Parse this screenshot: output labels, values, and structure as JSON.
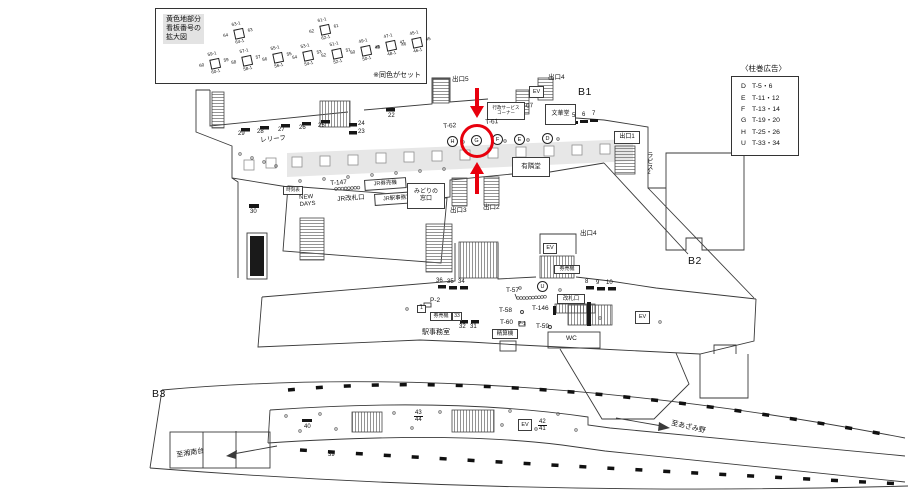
{
  "legend_signs": {
    "heading": "黄色地部分\n看板番号の\n拡大図",
    "note": "※同色がセット",
    "clusters": [
      {
        "top": "63-1",
        "left": "64",
        "right": "63",
        "bottom": "64-1"
      },
      {
        "top": "61-1",
        "left": "62",
        "right": "61",
        "bottom": "62-1"
      },
      {
        "top": "59-1",
        "left": "60",
        "right": "59",
        "bottom": "60-1"
      },
      {
        "top": "57-1",
        "left": "58",
        "right": "57",
        "bottom": "58-1"
      },
      {
        "top": "55-1",
        "left": "56",
        "right": "55",
        "bottom": "56-1"
      },
      {
        "top": "53-1",
        "left": "54",
        "right": "53",
        "bottom": "54-1"
      },
      {
        "top": "51-1",
        "left": "52",
        "right": "51",
        "bottom": "52-1"
      },
      {
        "top": "49-1",
        "left": "50",
        "right": "49",
        "bottom": "50-1"
      },
      {
        "top": "47-1",
        "left": "48",
        "right": "47",
        "bottom": "48-1"
      },
      {
        "top": "45-1",
        "left": "46",
        "right": "45",
        "bottom": "46-1"
      }
    ]
  },
  "legend_pillar": {
    "title": "〈柱巻広告〉",
    "rows": [
      {
        "key": "D",
        "value": "T-5・6"
      },
      {
        "key": "E",
        "value": "T-11・12"
      },
      {
        "key": "F",
        "value": "T-13・14"
      },
      {
        "key": "G",
        "value": "T-19・20"
      },
      {
        "key": "H",
        "value": "T-25・26"
      },
      {
        "key": "U",
        "value": "T-33・34"
      }
    ]
  },
  "b1": {
    "floor": "B1",
    "exit5": "出口5",
    "exit4": "出口4",
    "exit1": "出口1",
    "exit2": "出口2",
    "exit3": "出口3",
    "ev": "EV",
    "t62": "T-62",
    "t61": "T-61",
    "t67": "T-67",
    "t147": "T-147",
    "admin": "行政サービス\nコーナー",
    "bunkado": "文華堂",
    "yurindo": "有隣堂",
    "lapis": "ラピス2",
    "relief": "レリーフ",
    "timetable": "時刻表",
    "newdays": "NEW\nDAYS",
    "jr_gate": "JR改札口",
    "jr_tvm": "JR券売機",
    "jr_office": "JR駅事務室",
    "midori": "みどりの\n窓口",
    "wall_numbers": [
      "29",
      "28",
      "27",
      "26",
      "25"
    ],
    "n24": "24",
    "n23": "23",
    "n22": "22",
    "n30": "30",
    "gate_numbers": [
      "5",
      "6",
      "7"
    ],
    "pillars": [
      "H",
      "G",
      "F",
      "E",
      "D"
    ]
  },
  "b2": {
    "floor": "B2",
    "exit4": "出口4",
    "ev": "EV",
    "tvm": "券売機",
    "left_numbers": [
      "36",
      "35",
      "34"
    ],
    "right_numbers": [
      "8",
      "9",
      "10"
    ],
    "n33": "33",
    "n32": "32",
    "n31": "31",
    "n1": "1",
    "p2": "P-2",
    "p1": "P-1",
    "t57": "T-57",
    "t58": "T-58",
    "t59": "T-59",
    "t60": "T-60",
    "t146": "T-146",
    "gate": "改札口",
    "office": "駅事務室",
    "fare_machine": "精算機",
    "wc": "WC",
    "pillar": "U"
  },
  "b3": {
    "floor": "B3",
    "to_shonandai": "至湘南台",
    "to_azamino": "至あざみ野",
    "n39": "39",
    "n40": "40",
    "n43": "43",
    "n44": "44",
    "n42": "42",
    "n41": "41",
    "ev": "EV"
  },
  "annotation": {
    "highlight_color": "#e8000d"
  }
}
